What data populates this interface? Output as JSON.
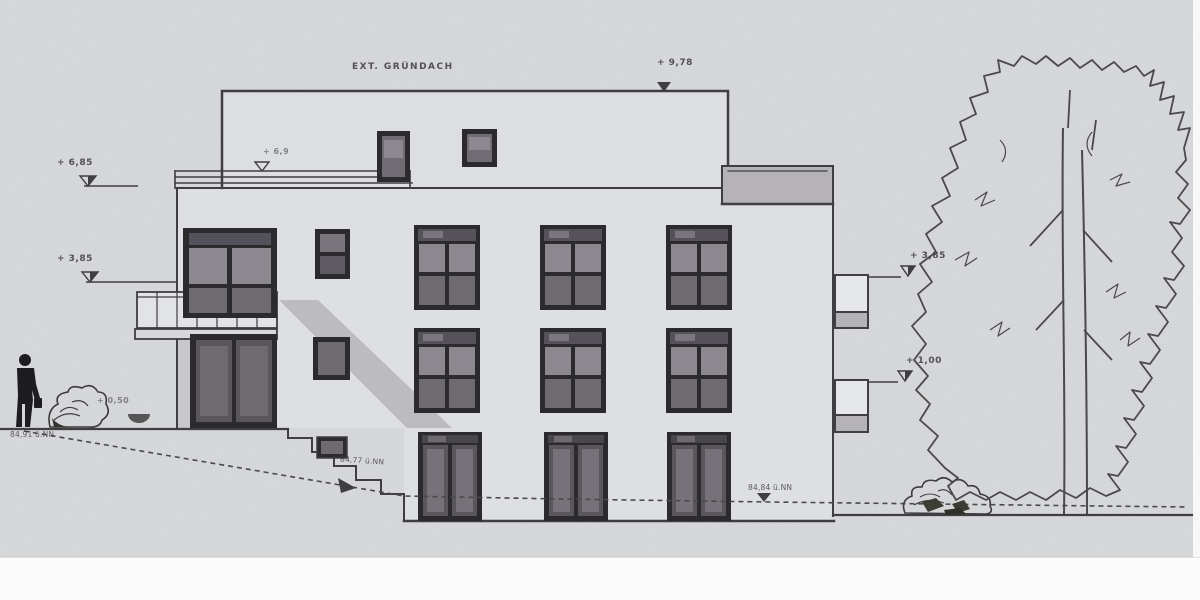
{
  "labels": {
    "roof_note": "EXT. GRÜNDACH",
    "elev_top": "+ 9,78",
    "elev_left_upper": "+ 6,85",
    "elev_parapet": "+ 6,9",
    "elev_left_mid": "+ 3,85",
    "elev_ground": "+ 0,50",
    "elev_nn_left": "84,91 ü.NN",
    "elev_nn_slope": "84,77 ü.NN",
    "elev_nn_bottom": "84,84 ü.NN",
    "elev_right_upper": "+ 3,85",
    "elev_right_lower": "+ 1,00"
  },
  "colors": {
    "paper": "#d8dadc",
    "line": "#3f3e40",
    "frame": "#2b2a2c",
    "glassLight": "#8d8890",
    "glassMid": "#6f6a70",
    "slab": "#b5b3b5",
    "shadow": "#a09da1",
    "white": "#fbfbfb"
  },
  "drawing": {
    "kind": "building elevation (architectural section/Ansicht)",
    "features": [
      "flat-roof apartment building",
      "green roof note",
      "elevation markers",
      "terrain slope with steps",
      "tree",
      "bushes",
      "person silhouette"
    ]
  }
}
